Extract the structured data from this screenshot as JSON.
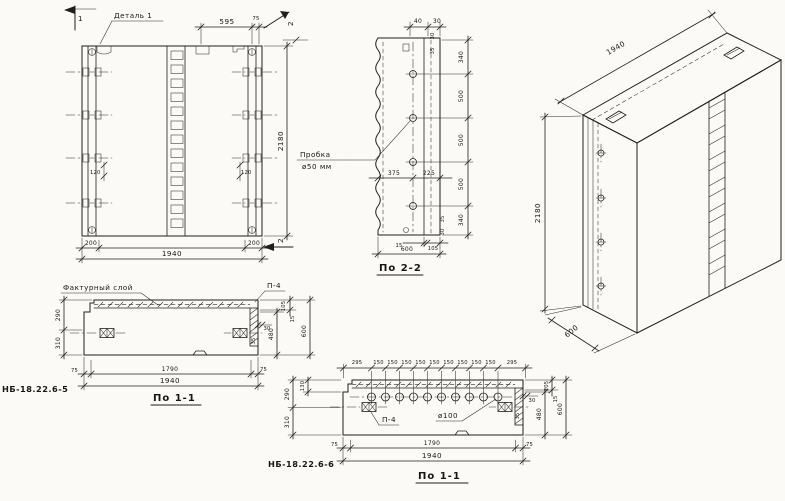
{
  "front_view": {
    "detail_label": "Деталь 1",
    "marker_1": "1",
    "marker_2_top": "2",
    "marker_2_bottom": "2",
    "dims": {
      "d595": "595",
      "d75": "75",
      "d120": "120",
      "d200": "200",
      "d1940": "1940",
      "d2180": "2180"
    }
  },
  "section_2_2": {
    "title": "По 2-2",
    "plug_line1": "Пробка",
    "plug_line2": "ø50 мм",
    "dims": {
      "d40": "40",
      "d30": "30",
      "d35": "35",
      "d340": "340",
      "d500": "500",
      "d375": "375",
      "d225": "225",
      "d15": "15",
      "d105": "105",
      "d600": "600"
    }
  },
  "iso_view": {
    "dims": {
      "d1940": "1940",
      "d2180": "2180",
      "d600": "600"
    }
  },
  "section_1_1_a": {
    "title": "По 1-1",
    "mark": "НБ-18.22.6-5",
    "facture_label": "Фактурный слой",
    "p4_label": "П-4",
    "dims": {
      "d290": "290",
      "d310": "310",
      "d105": "105",
      "d15": "15",
      "d30": "30",
      "d35": "35",
      "d480": "480",
      "d600": "600",
      "d75": "75",
      "d1790": "1790",
      "d1940": "1940"
    }
  },
  "section_1_1_b": {
    "title": "По 1-1",
    "mark": "НБ-18.22.6-6",
    "p4_label": "П-4",
    "hole_label": "ø100",
    "dims": {
      "d295": "295",
      "d150": "150",
      "d130": "130",
      "d290": "290",
      "d310": "310",
      "d105": "105",
      "d15": "15",
      "d30": "30",
      "d35": "35",
      "d480": "480",
      "d600": "600",
      "d75": "75",
      "d1790": "1790",
      "d1940": "1940"
    }
  }
}
